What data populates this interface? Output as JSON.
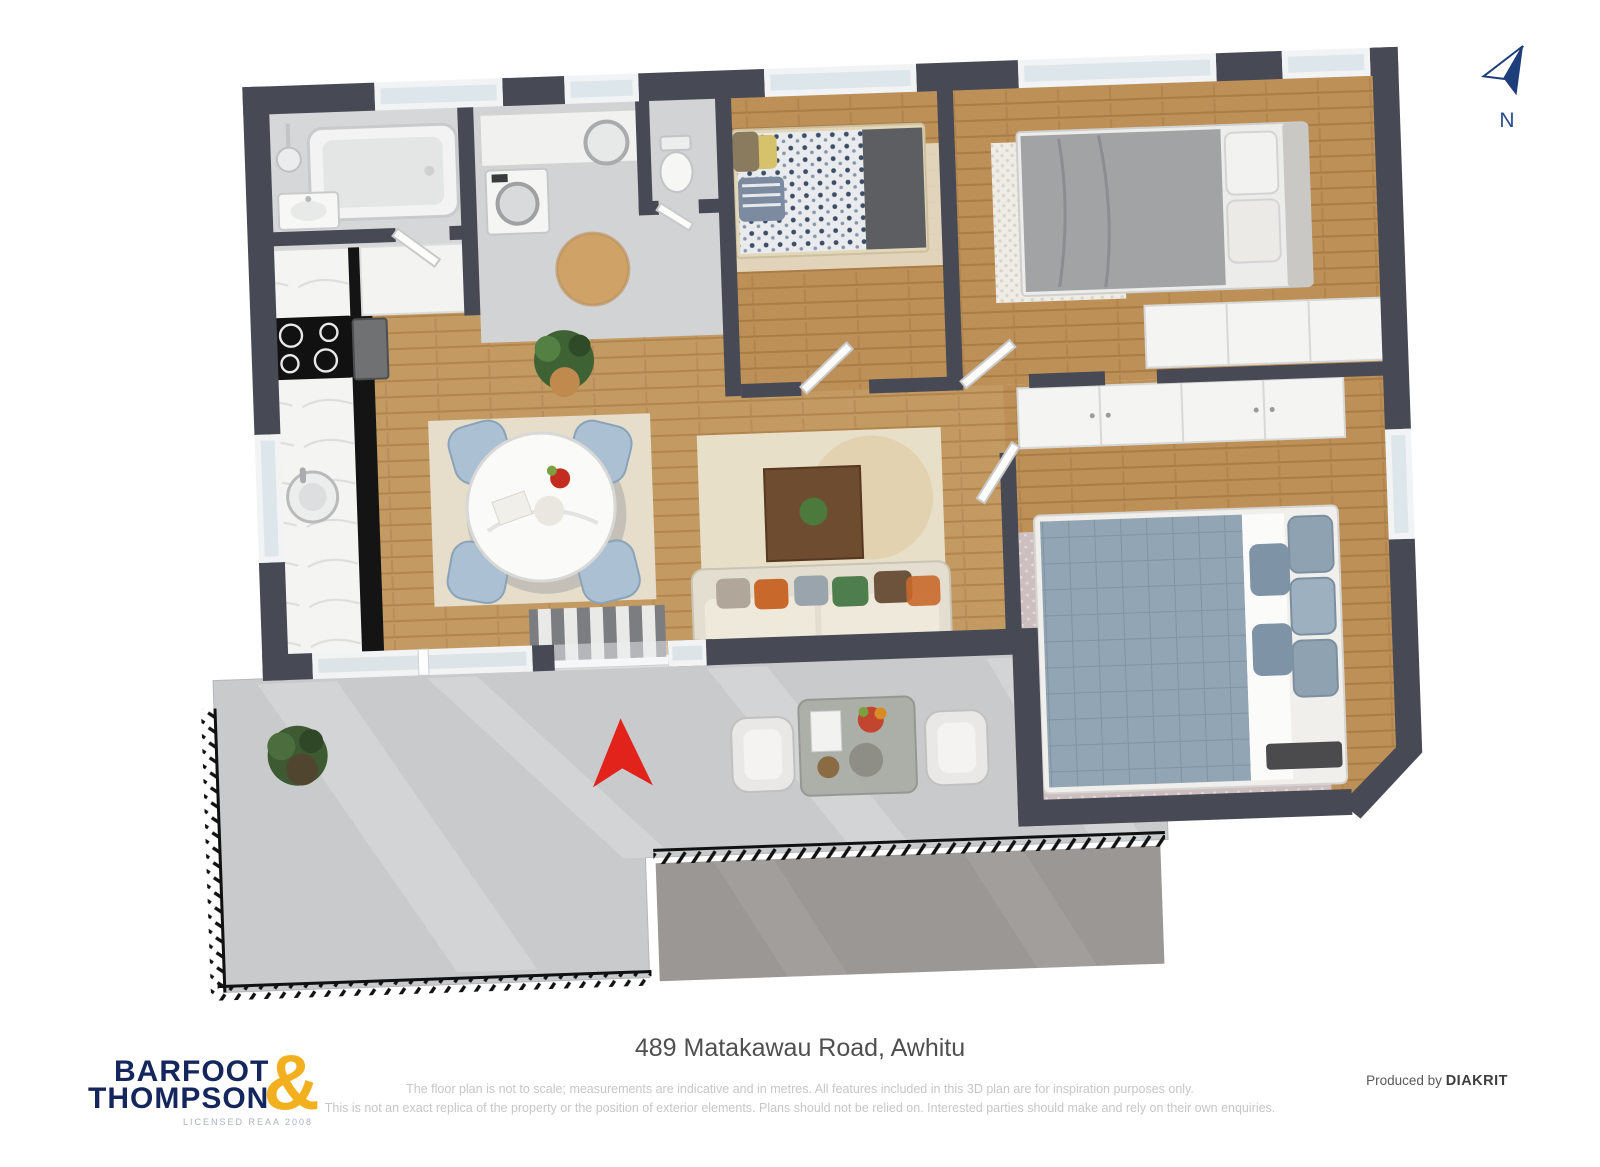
{
  "north_indicator": {
    "label": "N",
    "icon": "north-arrow-icon",
    "color": "#1e3d7b"
  },
  "entry_marker": {
    "icon": "entry-arrow-icon",
    "color": "#e2231c"
  },
  "footer": {
    "logo": {
      "line1": "BARFOOT",
      "line2": "THOMPSON",
      "ampersand": "&",
      "sub": "LICENSED REAA 2008",
      "navy": "#15265d",
      "gold": "#f2b01e"
    },
    "address": "489 Matakawau Road, Awhitu",
    "disclaimer_line1": "The floor plan is not to scale; measurements are indicative and in metres. All features included in this 3D plan are for inspiration purposes only.",
    "disclaimer_line2": "This is not an exact replica of the property or the position of exterior elements. Plans should not be relied on. Interested parties should make and rely on their own enquiries.",
    "produced_by": "Produced by",
    "producer": "DIAKRIT"
  },
  "floorplan": {
    "colors": {
      "outer_wall": "#474a55",
      "wood_floor": "#c49a63",
      "bath_floor": "#d6d7d9",
      "deck_concrete": "#c8cacb",
      "gravel_path": "#9a9795",
      "rug_beige": "#e6ddca",
      "sofa_cream": "#e3decf",
      "bed_gray": "#9fa0a3",
      "bed_blue_gray": "#8fa2b2",
      "dining_chair_blue": "#abc0d2",
      "coffee_table_wood": "#6d4c30",
      "accent_red": "#e2231c"
    }
  }
}
